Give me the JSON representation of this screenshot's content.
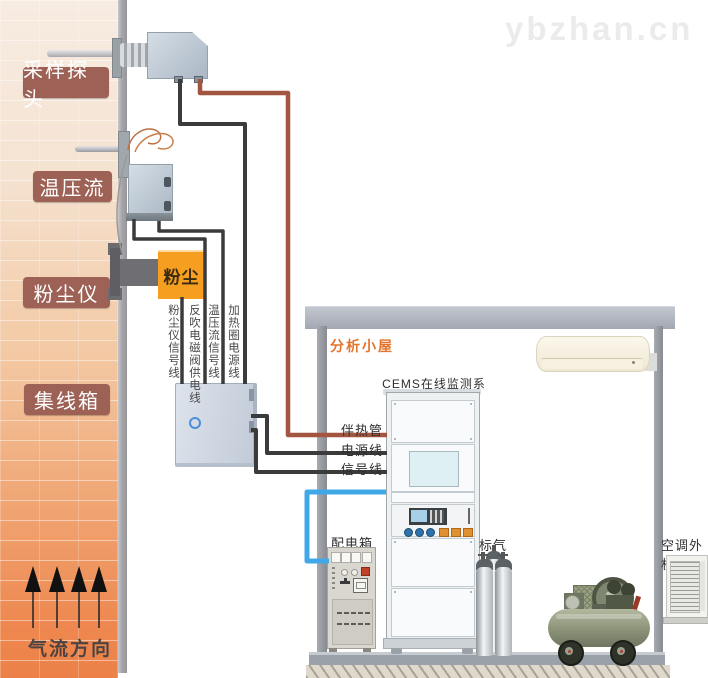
{
  "watermark": "ybzhan.cn",
  "chimney": {
    "labels": {
      "sampling_probe": "采样探头",
      "temp_pressure_flow": "温压流",
      "dust_meter": "粉尘仪",
      "junction_box": "集线箱"
    },
    "airflow_direction": "气流方向"
  },
  "devices": {
    "dust_meter_text": "粉尘"
  },
  "cables": {
    "dust_signal": "粉尘仪信号线",
    "blowback_power": "反吹电磁阀供电线",
    "tpf_signal": "温压流信号线",
    "heater_power": "加热圈电源线",
    "heat_trace": "伴热管",
    "power_line": "电源线",
    "signal_line": "信号线"
  },
  "house": {
    "title": "分析小屋",
    "cems_system": "CEMS在线监测系统",
    "power_box": "配电箱",
    "standard_gas": "标气",
    "ac_outdoor": "空调外机"
  },
  "colors": {
    "label_box": "#9d6155",
    "house_title": "#e4742c",
    "dust_box": "#f59e20",
    "cable_black": "#3b3b3b",
    "cable_brown": "#a2563f",
    "cable_blue": "#41a8e8"
  }
}
